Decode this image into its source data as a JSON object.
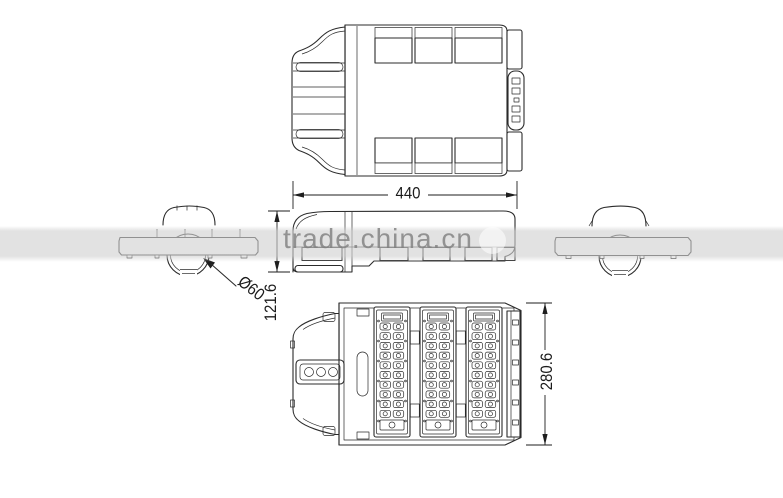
{
  "watermark": {
    "text": "trade.china.cn",
    "band_color": "#d0d0d0",
    "text_color": "#808080"
  },
  "dimensions": {
    "overall_length": "440",
    "mount_diameter": "Ø60",
    "side_height": "121.6",
    "body_width": "280.6"
  },
  "drawing": {
    "line_color": "#2b2b2b",
    "bottom_view": {
      "module_count": 3,
      "led_rows": 10,
      "led_cols": 2
    }
  }
}
